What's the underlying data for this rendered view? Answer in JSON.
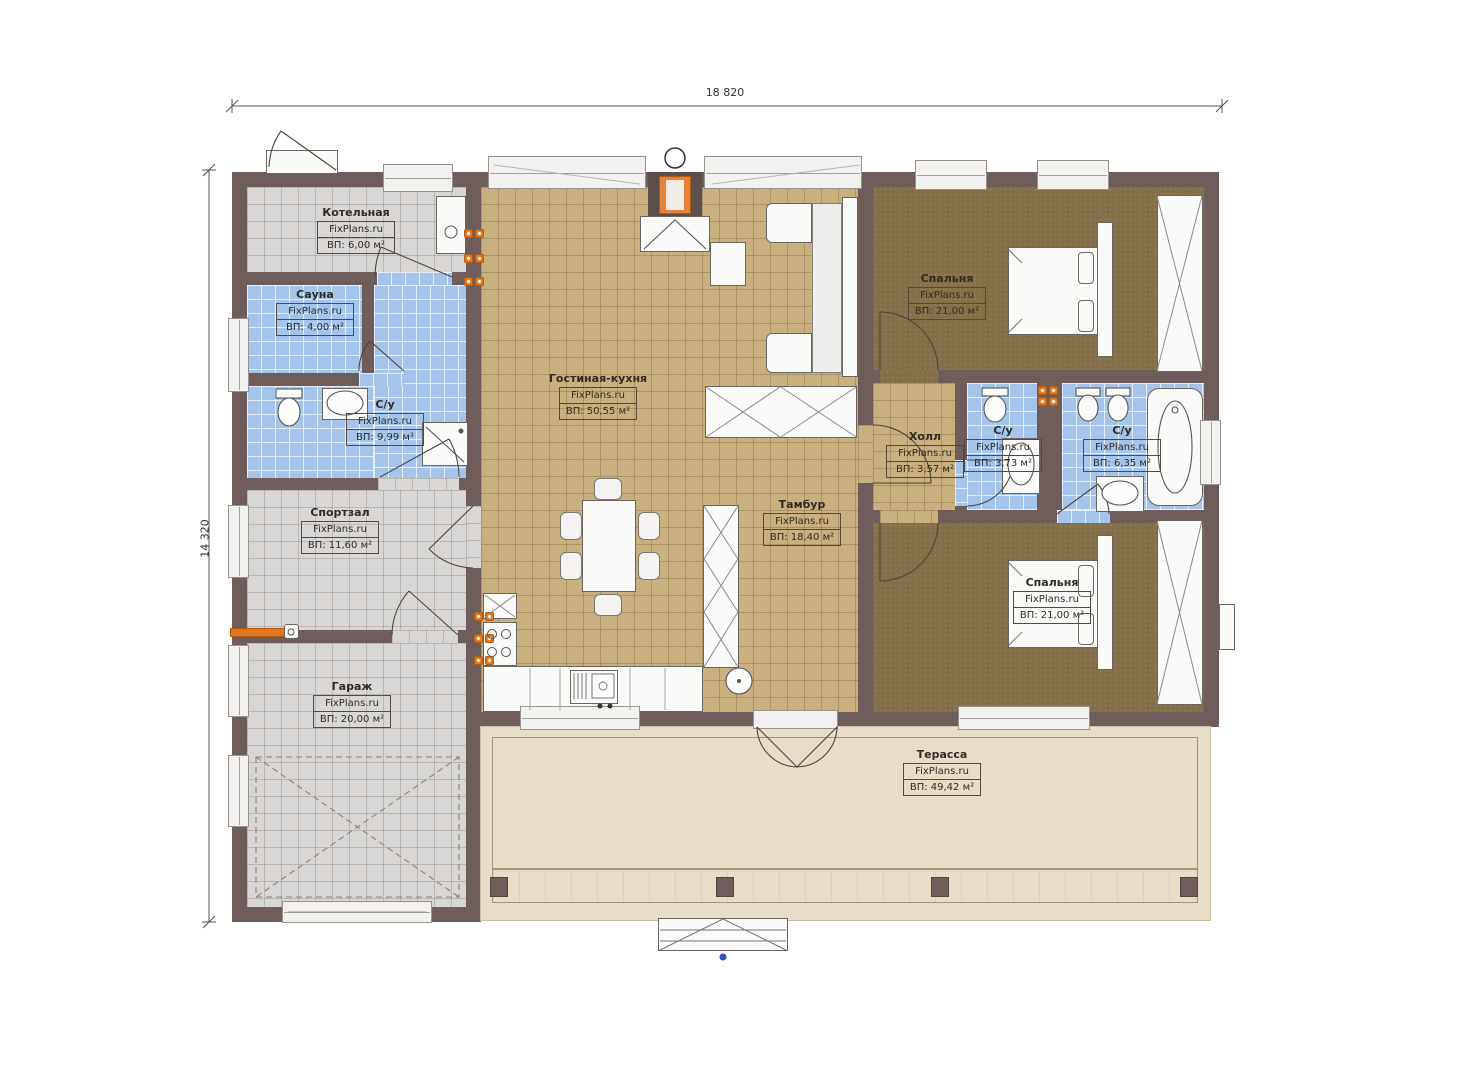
{
  "dims": {
    "width": "18 820",
    "height": "14 320"
  },
  "watermark": "FixPlans.ru",
  "rooms": [
    {
      "name": "Котельная",
      "area": "ВП: 6,00 м²"
    },
    {
      "name": "Сауна",
      "area": "ВП: 4,00 м²"
    },
    {
      "name": "С/у",
      "area": "ВП: 9,99 м²"
    },
    {
      "name": "Спортзал",
      "area": "ВП: 11,60 м²"
    },
    {
      "name": "Гараж",
      "area": "ВП: 20,00 м²"
    },
    {
      "name": "Гостиная-кухня",
      "area": "ВП: 50,55 м²"
    },
    {
      "name": "Тамбур",
      "area": "ВП: 18,40 м²"
    },
    {
      "name": "Спальня",
      "area": "ВП: 21,00 м²"
    },
    {
      "name": "Холл",
      "area": "ВП: 3,57 м²"
    },
    {
      "name": "С/у",
      "area": "ВП: 3,73 м²"
    },
    {
      "name": "С/у",
      "area": "ВП: 6,35 м²"
    },
    {
      "name": "Спальня",
      "area": "ВП: 21,00 м²"
    },
    {
      "name": "Терасса",
      "area": "ВП: 49,42 м²"
    }
  ],
  "colors": {
    "wall": "#6e5d5a",
    "tile_gray": "#d8d7d5",
    "tile_blue": "#a4c4ec",
    "tile_tan": "#c9b07f",
    "floor_brown": "#837048",
    "terrace": "#e8ddc9",
    "accent_orange": "#e2761e",
    "marker_blue": "#2f4fc0"
  }
}
